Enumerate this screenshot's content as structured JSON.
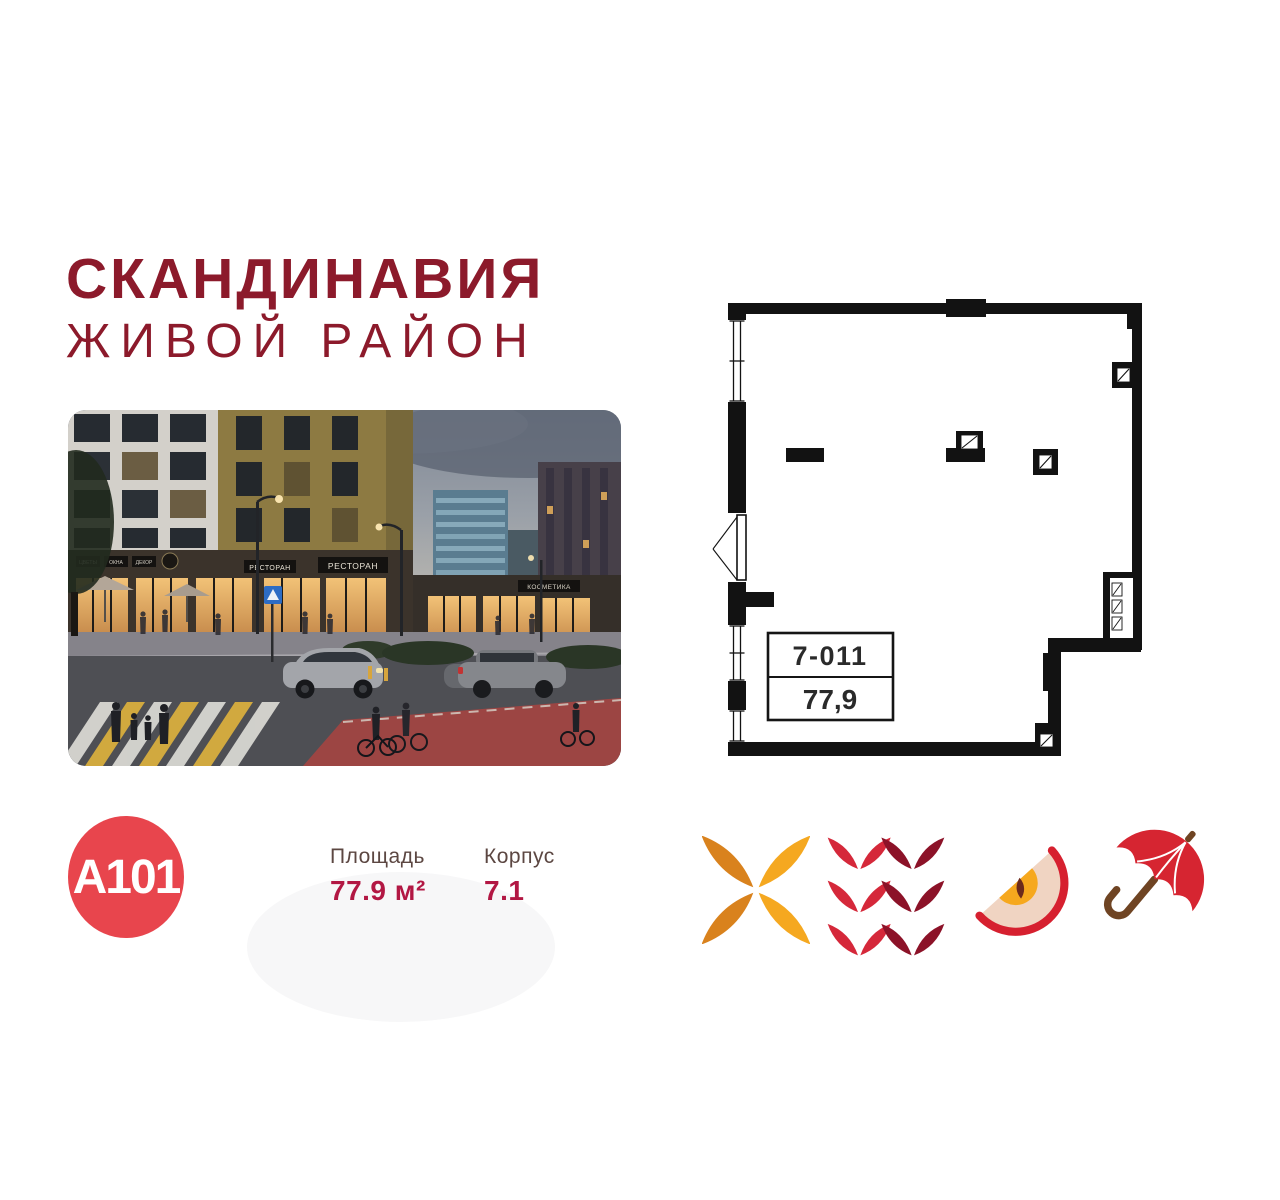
{
  "header": {
    "title": "СКАНДИНАВИЯ",
    "subtitle": "ЖИВОЙ РАЙОН"
  },
  "logo": {
    "text": "A101"
  },
  "stats": {
    "items": [
      {
        "label": "Площадь",
        "value": "77.9 м²"
      },
      {
        "label": "Корпус",
        "value": "7.1"
      }
    ]
  },
  "floorplan": {
    "unit_number": "7-011",
    "area": "77,9"
  },
  "photo": {
    "signs": {
      "small1": "ЦВЕТЫ",
      "small2": "ОКНА",
      "small3": "ДЕКОР",
      "restaurant1": "РЕСТОРАН",
      "restaurant2": "РЕСТОРАН",
      "cosmetics": "КОСМЕТИКА"
    }
  },
  "icons": [
    {
      "name": "pinwheel-leaves-icon"
    },
    {
      "name": "berry-leaves-icon"
    },
    {
      "name": "apple-slice-icon"
    },
    {
      "name": "umbrella-icon"
    }
  ],
  "colors": {
    "brand_red": "#E8454D",
    "title_maroon": "#8C1A2B",
    "value_crimson": "#B21743",
    "label_brown": "#5C4742",
    "plan_black": "#121212",
    "icon_orange_dark": "#D9821D",
    "icon_amber": "#F5A820",
    "icon_red": "#D5283A",
    "icon_maroon": "#8C1228",
    "icon_handle_brown": "#6F4423",
    "apple_flesh": "#F0D4C2"
  }
}
